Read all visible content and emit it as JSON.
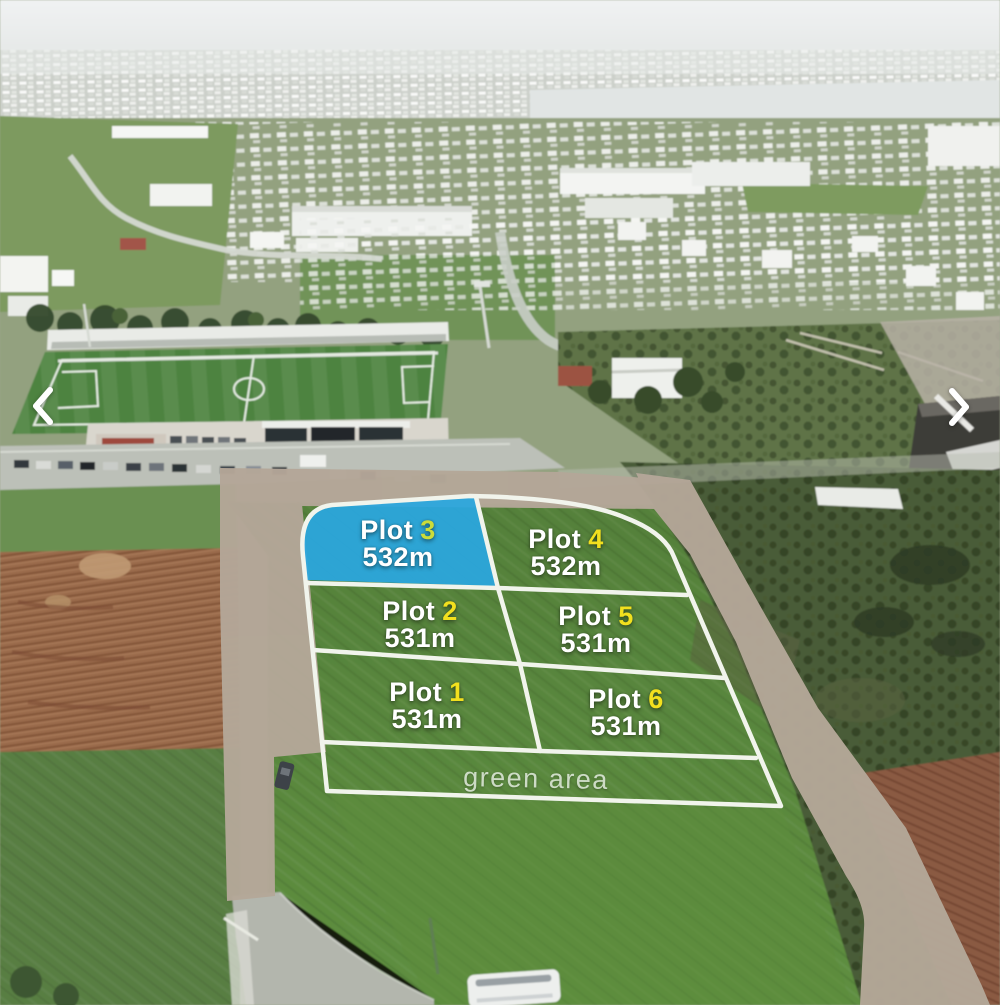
{
  "viewer": {
    "prev_icon": "chevron-left",
    "next_icon": "chevron-right"
  },
  "plots": [
    {
      "label": "Plot",
      "number": "3",
      "area": "532m",
      "highlighted": true
    },
    {
      "label": "Plot",
      "number": "4",
      "area": "532m",
      "highlighted": false
    },
    {
      "label": "Plot",
      "number": "2",
      "area": "531m",
      "highlighted": false
    },
    {
      "label": "Plot",
      "number": "5",
      "area": "531m",
      "highlighted": false
    },
    {
      "label": "Plot",
      "number": "1",
      "area": "531m",
      "highlighted": false
    },
    {
      "label": "Plot",
      "number": "6",
      "area": "531m",
      "highlighted": false
    }
  ],
  "green_area_label": "green area",
  "colors": {
    "plot_highlight_fill": "#2aa7e0",
    "plot_number": "#f2e01e",
    "plot_number_on_highlight": "#cbdc3a",
    "plot_label_text": "#ffffff",
    "boundary_lines": "#f1f4ec",
    "road_overlay": "#b4a798",
    "nav_arrow": "#ffffff"
  }
}
